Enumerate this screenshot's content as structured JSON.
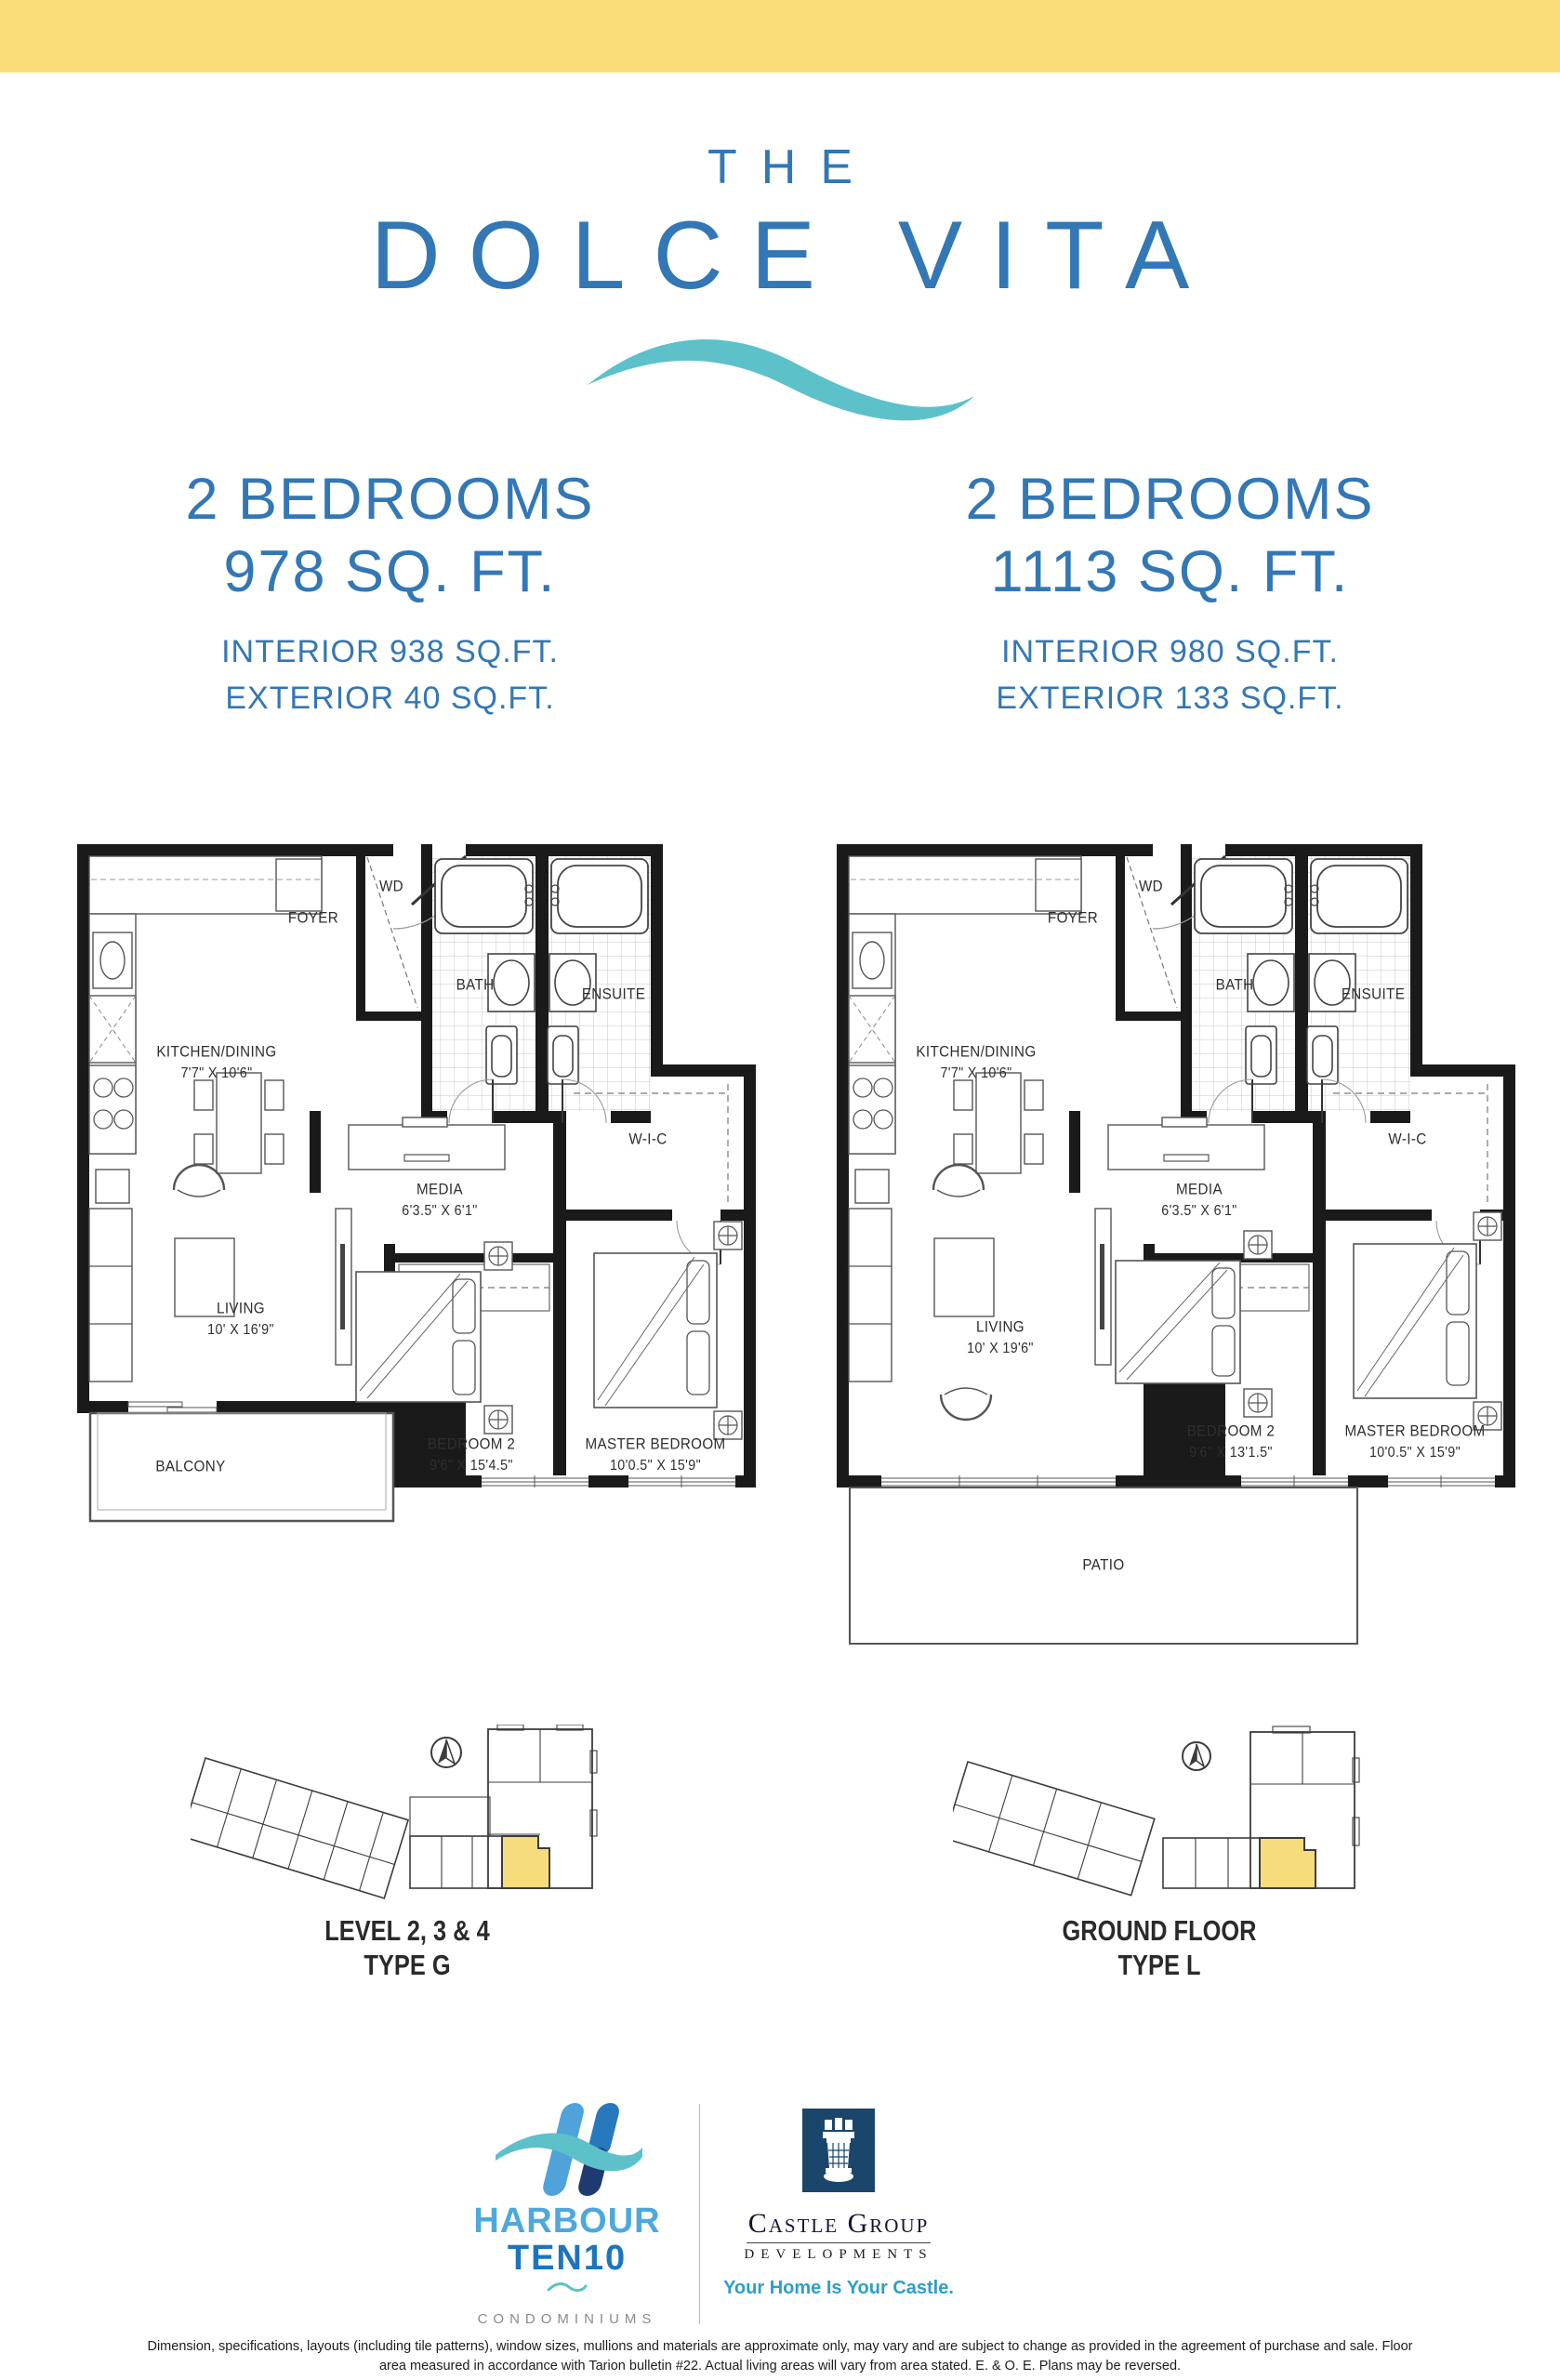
{
  "colors": {
    "banner_yellow": "#FBDC79",
    "brand_blue": "#3377B5",
    "wave_teal": "#5CC1C9",
    "unit_highlight_yellow": "#F7DC7D",
    "castle_navy": "#1A466B",
    "tagline_blue": "#2D9FC8"
  },
  "header": {
    "kicker": "THE",
    "title": "DOLCE VITA"
  },
  "units": [
    {
      "bedrooms": "2 BEDROOMS",
      "area": "978 SQ. FT.",
      "interior": "INTERIOR 938 SQ.FT.",
      "exterior": "EXTERIOR 40 SQ.FT."
    },
    {
      "bedrooms": "2 BEDROOMS",
      "area": "1113 SQ. FT.",
      "interior": "INTERIOR 980 SQ.FT.",
      "exterior": "EXTERIOR 133 SQ.FT."
    }
  ],
  "plans": [
    {
      "rooms": {
        "foyer": "FOYER",
        "wd": "WD",
        "bath": "BATH",
        "ensuite": "ENSUITE",
        "wic": "W-I-C",
        "kitchen": {
          "name": "KITCHEN/DINING",
          "dims": "7'7\" X 10'6\""
        },
        "media": {
          "name": "MEDIA",
          "dims": "6'3.5\" X 6'1\""
        },
        "living": {
          "name": "LIVING",
          "dims": "10' X 16'9\""
        },
        "bedroom2": {
          "name": "BEDROOM 2",
          "dims": "9'6\" X 15'4.5\""
        },
        "master": {
          "name": "MASTER BEDROOM",
          "dims": "10'0.5\" X 15'9\""
        },
        "outdoor": "BALCONY"
      },
      "keyplan": {
        "line1": "LEVEL 2, 3 & 4",
        "line2": "TYPE G"
      }
    },
    {
      "rooms": {
        "foyer": "FOYER",
        "wd": "WD",
        "bath": "BATH",
        "ensuite": "ENSUITE",
        "wic": "W-I-C",
        "kitchen": {
          "name": "KITCHEN/DINING",
          "dims": "7'7\" X 10'6\""
        },
        "media": {
          "name": "MEDIA",
          "dims": "6'3.5\" X 6'1\""
        },
        "living": {
          "name": "LIVING",
          "dims": "10' X 19'6\""
        },
        "bedroom2": {
          "name": "BEDROOM 2",
          "dims": "9'6\" X 13'1.5\""
        },
        "master": {
          "name": "MASTER BEDROOM",
          "dims": "10'0.5\" X 15'9\""
        },
        "outdoor": "PATIO"
      },
      "keyplan": {
        "line1": "GROUND FLOOR",
        "line2": "TYPE L"
      }
    }
  ],
  "footer": {
    "harbour": {
      "line1": "HARBOUR",
      "line2": "TEN10",
      "sub": "CONDOMINIUMS"
    },
    "castle": {
      "name": "Castle Group",
      "division": "DEVELOPMENTS",
      "tagline": "Your Home Is Your Castle."
    }
  },
  "disclaimer": {
    "line1": "Dimension, specifications, layouts (including tile patterns), window sizes, mullions and materials are approximate only, may vary and are subject to change as provided in the agreement of purchase and sale. Floor",
    "line2": "area measured in accordance with Tarion bulletin #22. Actual living areas will vary from area stated. E. & O. E. Plans may be reversed."
  }
}
